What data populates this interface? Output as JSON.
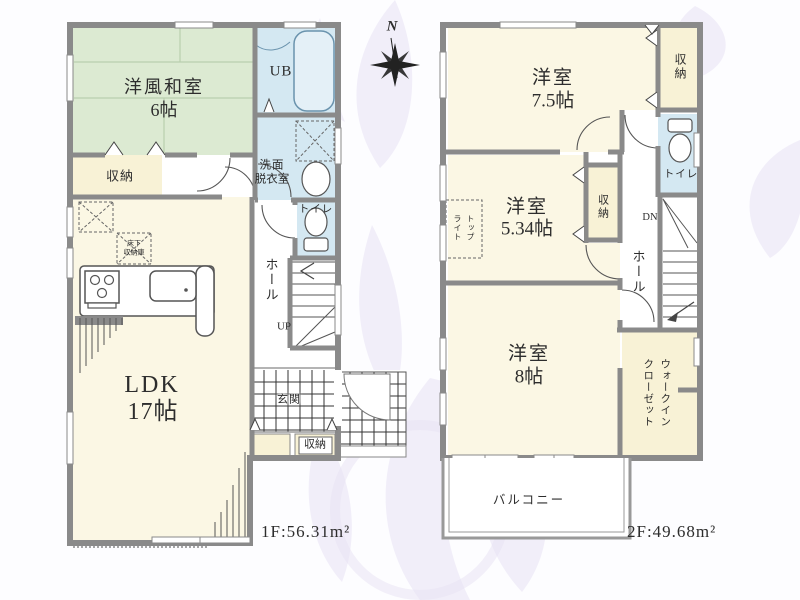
{
  "compass": {
    "label": "N"
  },
  "floor1": {
    "area": "1F:56.31m²",
    "washitsu": {
      "name": "洋風和室",
      "size": "6帖"
    },
    "bath": "UB",
    "washroom": [
      "洗面",
      "脱衣室"
    ],
    "storage_north": "収納",
    "toilet": "トイレ",
    "hall": "ホール",
    "stairs_dir": "UP",
    "ldk": {
      "name": "LDK",
      "size": "17帖"
    },
    "underfloor": [
      "床下",
      "収納庫"
    ],
    "entrance": "玄関",
    "storage_entrance": "収納"
  },
  "floor2": {
    "area": "2F:49.68m²",
    "bedroom_75": {
      "name": "洋室",
      "size": "7.5帖"
    },
    "storage_north": "収納",
    "toilet": "トイレ",
    "bedroom_534": {
      "name": "洋室",
      "size": "5.34帖"
    },
    "storage_mid": "収納",
    "skylight": [
      "トップ",
      "ライト"
    ],
    "stairs_dir": "DN",
    "hall": "ホール",
    "bedroom_8": {
      "name": "洋室",
      "size": "8帖"
    },
    "wic": [
      "ウォークイン",
      "クローゼット"
    ],
    "balcony": "バルコニー"
  },
  "colors": {
    "tatami": "#dcead2",
    "water": "#d4e8f2",
    "room": "#fbf7e4",
    "storage": "#f8f2d6",
    "wall": "#8a8a8a",
    "flourish": "#e8e2f4"
  }
}
